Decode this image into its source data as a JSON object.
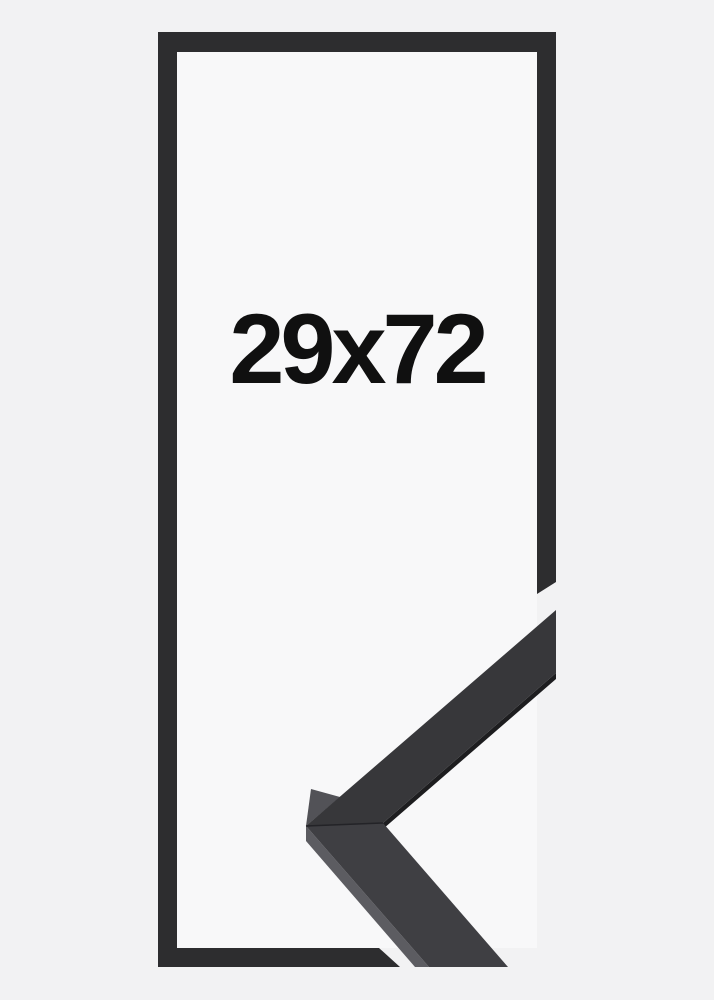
{
  "frame_preview": {
    "size_label": "29x72"
  },
  "colors": {
    "background": "#f2f2f3",
    "frame_opening": "#f8f8f9",
    "frame_outline": "#2d2d2f",
    "moulding_face_upper": "#37373a",
    "moulding_face_lower": "#3f3f43",
    "moulding_side_upper": "#525257",
    "moulding_side_lower": "#5c5c61",
    "moulding_edge": "#1d1d1f",
    "miter_seam": "#232327",
    "label": "#101010"
  }
}
